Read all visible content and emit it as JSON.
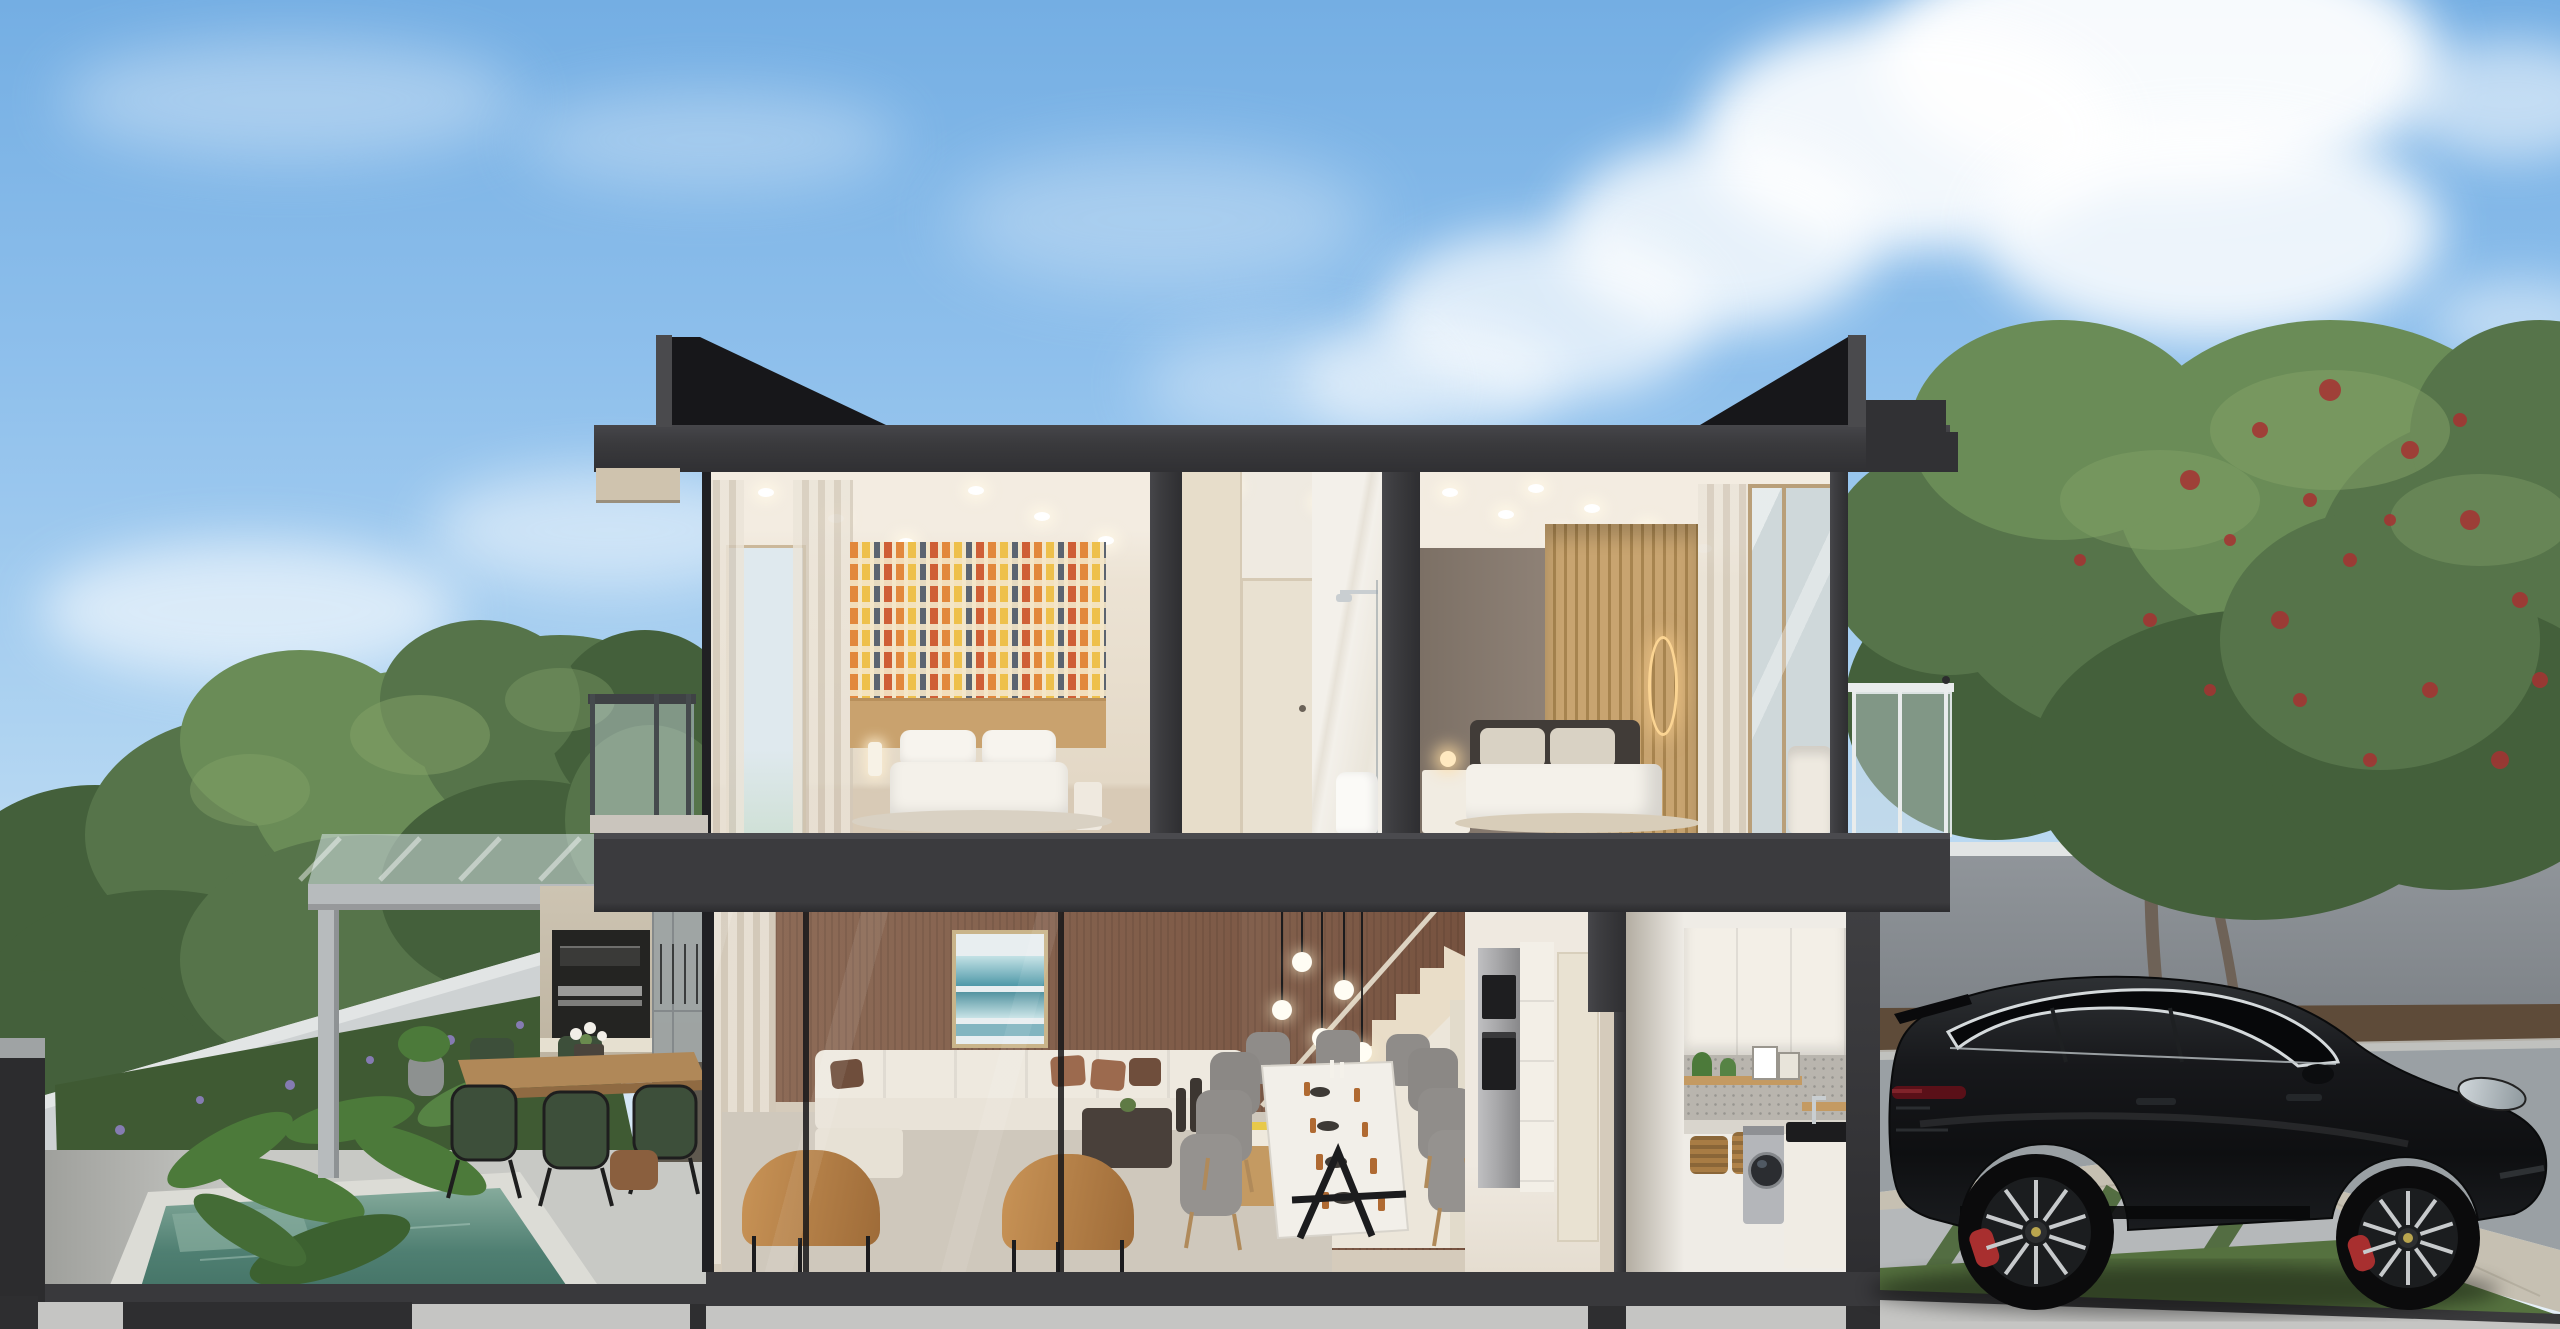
{
  "scene_type": "architectural cross-section render of a two-story villa with pool, garden and parked SUV",
  "colors": {
    "sky_top": "#74aee3",
    "sky_mid": "#8fc0ec",
    "sky_low": "#aed3f1",
    "sky_horizon": "#cfe4f5",
    "cloud": "#ffffff",
    "roof_dark": "#3a3a3d",
    "roof_black": "#17171a",
    "cornice": "#cfc3ae",
    "slab": "#3b3b3e",
    "partition": "#3d3d40",
    "cut_edge": "#202023",
    "ceiling": "#f3ece1",
    "bedroom_wall": "#ece3d4",
    "floor_wood": "#d8cab6",
    "wallpaper_base": "#f3e6c9",
    "wallpaper_orange": "#e2883c",
    "wallpaper_red": "#cf5f36",
    "wallpaper_yellow": "#eec04b",
    "wallpaper_gray": "#5c6470",
    "headboard_wood": "#c9a26e",
    "bed_white": "#f4f1ea",
    "curtain": "#d9cfc0",
    "bath_wall": "#efeae1",
    "bath_door": "#e9e1d1",
    "marble": "#f3f0ea",
    "taupe_wall": "#8e8176",
    "slat_light": "#c8a470",
    "slat_dark": "#a7844f",
    "lamp_glow": "#ffd9a0",
    "railing_white": "#e9ecec",
    "glass": "#cfd8da",
    "brown_wall": "#8d6b57",
    "brown_wall_dark": "#76523f",
    "art_teal": "#3e8fa0",
    "art_light": "#bfe0e4",
    "frame_wood": "#c9b48a",
    "sofa": "#ece7dd",
    "pillow_rust": "#9c6a4e",
    "pillow_brown": "#6f4e3c",
    "leather": "#bf8a52",
    "rug": "#cfc8bc",
    "floor_tile": "#d5cbbb",
    "dining_chair": "#8f8c89",
    "table_white": "#f2efe9",
    "table_leg": "#1c1c1e",
    "amber": "#b06a32",
    "stair_cream": "#e9ddc8",
    "stair_wall_white": "#ece6da",
    "steel": "#a8a8aa",
    "appliance_dark": "#1e1e20",
    "cabinet_white": "#f3efe7",
    "splash_gray": "#b9b5ae",
    "shelf_wood": "#c49a62",
    "basket": "#a87c44",
    "washer": "#b4b6ba",
    "washer_door": "#2b2d31",
    "sink_black": "#1c1c1e",
    "pergola": "#b7bbbd",
    "bbq_wall": "#cdc4b2",
    "bbq_niche": "#242422",
    "grill_steel": "#9a9a98",
    "outdoor_table": "#b08858",
    "chair_green": "#3d4f3a",
    "pouf": "#8a5f3e",
    "wall_white": "#ced2d3",
    "wall_cap": "#e2e5e5",
    "hedge": "#3f5a33",
    "leaf": "#4c7a3a",
    "flower_purple": "#8d7fc0",
    "patio": "#c8c9c5",
    "pool_water": "#4f7f72",
    "pool_deep": "#3c6a5d",
    "pool_light": "#86ab9c",
    "coping": "#dcdcd6",
    "tree_dark": "#44603b",
    "tree_mid": "#56744a",
    "tree_light": "#6a8c57",
    "tree_hi": "#83a168",
    "berry": "#a63232",
    "trunk": "#6e6257",
    "grey_wall": "#90959a",
    "mulch": "#5e4b39",
    "road": "#9aa0a4",
    "paver": "#c6c0b2",
    "drive": "#b5b8ba",
    "grass": "#55713f",
    "grass_dark": "#4e6a3c",
    "car_body": "#141518",
    "car_hi": "#2e3134",
    "car_glass": "#07080a",
    "chrome": "#d0d7da",
    "tail_red": "#5a1018",
    "caliper": "#a82f2f",
    "rim": "#c7cacc",
    "base_dark": "#39393c",
    "base_gap": "#2e2e30",
    "base_light": "#c5c5c3"
  }
}
